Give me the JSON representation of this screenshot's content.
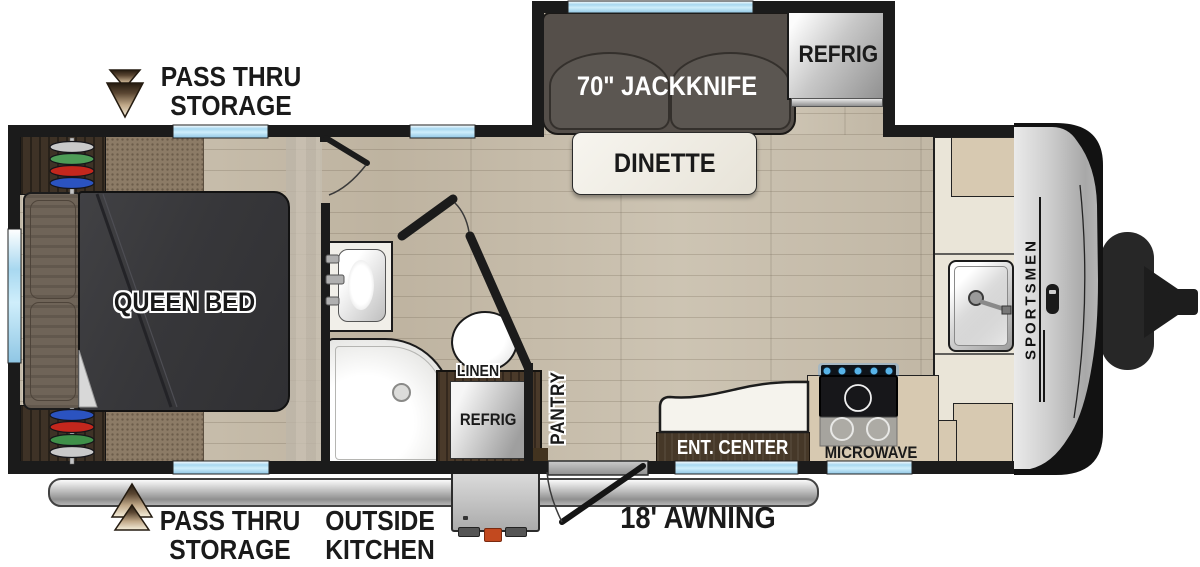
{
  "meta": {
    "type": "rv-floorplan",
    "brand_side_text": "SPORTSMEN"
  },
  "callouts": {
    "pass_thru_storage_top": {
      "line1": "PASS THRU",
      "line2": "STORAGE"
    },
    "pass_thru_storage_bottom": {
      "line1": "PASS THRU",
      "line2": "STORAGE"
    },
    "outside_kitchen": {
      "line1": "OUTSIDE",
      "line2": "KITCHEN"
    },
    "awning": "18' AWNING"
  },
  "features": {
    "sofa": "70\" JACKKNIFE",
    "dinette": "DINETTE",
    "refrig_main": "REFRIG",
    "refrig_outside": "REFRIG",
    "queen_bed": "QUEEN BED",
    "linen": "LINEN",
    "pantry": "PANTRY",
    "ent_center": "ENT. CENTER",
    "microwave": "MICROWAVE"
  },
  "colors": {
    "wall": "#1b1b1b",
    "window_blue": "#a8d8f0",
    "wood_floor": "#c6bcab",
    "carpet": "#8c7b66",
    "bed": "#39393b",
    "sofa": "#554f4a",
    "counter_beige": "#d7c9b1",
    "counter_cream": "#eae5d8",
    "cabinet_brown": "#463828",
    "arrow_tan": "#c0a888",
    "awning_gray": "#bdbdbd"
  }
}
